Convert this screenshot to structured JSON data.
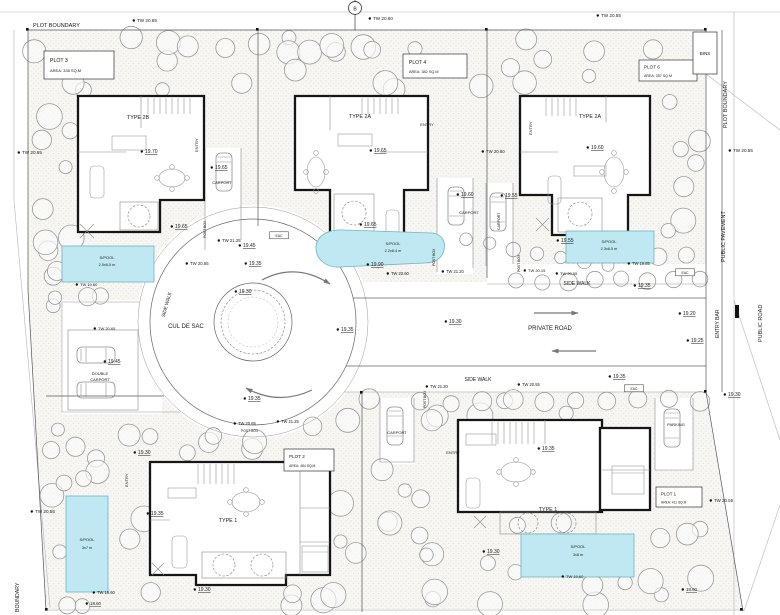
{
  "drawing": {
    "bins_label": "BINS"
  },
  "plots": [
    {
      "name": "PLOT 3",
      "area": "AREA: 338 SQ.M",
      "house_type": "TYPE 2B",
      "pool_label": "S/POOL",
      "pool_size": "2.5x6.5 m"
    },
    {
      "name": "PLOT 4",
      "area": "AREA: 382 SQ.M",
      "house_type": "TYPE 2A",
      "pool_label": "S/POOL",
      "pool_size": "2.2x8.4 m"
    },
    {
      "name": "PLOT 6",
      "area": "AREA: 357 SQ.M",
      "house_type": "TYPE 2A",
      "pool_label": "S/POOL",
      "pool_size": "2.3x6.5 m"
    },
    {
      "name": "PLOT 2",
      "area": "AREA: 484 SQ.M",
      "house_type": "TYPE 1",
      "pool_label": "S/POOL",
      "pool_size": "3x7 m"
    },
    {
      "name": "PLOT 1",
      "area": "AREA: 411 SQ.M",
      "house_type": "TYPE 1",
      "pool_label": "S/POOL",
      "pool_size": "3x8 m"
    }
  ],
  "labels": [
    {
      "t": "PLOT BOUNDARY",
      "x": 33,
      "y": 27,
      "s": 5.5,
      "n": "boundary-label"
    },
    {
      "t": "TW 20.65",
      "x": 137,
      "y": 22,
      "s": 4.6,
      "d": 1
    },
    {
      "t": "TW 20.60",
      "x": 373,
      "y": 20,
      "s": 4.6,
      "d": 1
    },
    {
      "t": "TW 20.55",
      "x": 601,
      "y": 17,
      "s": 4.6,
      "d": 1
    },
    {
      "t": "B",
      "x": 355,
      "y": 10.5,
      "s": 5,
      "a": "m",
      "n": "section-marker-label"
    },
    {
      "t": "PLOT BOUNDARY",
      "x": 727,
      "y": 128,
      "s": 5.5,
      "r": -90,
      "n": "boundary-label"
    },
    {
      "t": "TW 20.55",
      "x": 733,
      "y": 152,
      "s": 4.6,
      "d": 1
    },
    {
      "t": "PUBLIC PAVEMENT",
      "x": 725,
      "y": 262,
      "s": 5.5,
      "r": -90,
      "n": "boundary-label"
    },
    {
      "t": "ENTRY BAR",
      "x": 719,
      "y": 338,
      "s": 5,
      "r": -90,
      "n": "road-label"
    },
    {
      "t": "PUBLIC ROAD",
      "x": 762,
      "y": 342,
      "s": 5.5,
      "r": -90,
      "n": "road-label"
    },
    {
      "t": "TW 20.65",
      "x": 22,
      "y": 154,
      "s": 4.6,
      "d": 1
    },
    {
      "t": "TW 20.55",
      "x": 35,
      "y": 513,
      "s": 4.6,
      "d": 1
    },
    {
      "t": "BOUNDARY",
      "x": 19,
      "y": 612,
      "s": 5.2,
      "r": -90,
      "n": "boundary-label"
    },
    {
      "ref": "plots.0.house_type",
      "x": 138,
      "y": 119,
      "s": 5.4,
      "a": "m",
      "n": "house-type-label"
    },
    {
      "t": "ENTRY",
      "x": 198,
      "y": 152,
      "s": 4,
      "r": -90
    },
    {
      "t": "19.70",
      "x": 145,
      "y": 153,
      "u": 1,
      "d": 1
    },
    {
      "t": "19.65",
      "x": 215,
      "y": 169,
      "u": 1,
      "d": 1
    },
    {
      "t": "CARPORT",
      "x": 222,
      "y": 184,
      "s": 4,
      "a": "m"
    },
    {
      "ref": "plots.0.pool_label",
      "x": 107,
      "y": 259,
      "s": 4,
      "a": "m",
      "n": "pool-label"
    },
    {
      "ref": "plots.0.pool_size",
      "x": 107,
      "y": 266,
      "s": 3.8,
      "a": "m",
      "n": "pool-size-label"
    },
    {
      "t": "TW 19.60",
      "x": 80,
      "y": 286,
      "s": 4,
      "d": 1
    },
    {
      "t": "19.65",
      "x": 175,
      "y": 228,
      "u": 1,
      "d": 1
    },
    {
      "t": "POST BOX",
      "x": 206,
      "y": 238,
      "s": 3.4,
      "r": -90
    },
    {
      "t": "TW 21.25",
      "x": 222,
      "y": 242,
      "s": 4.3,
      "d": 1
    },
    {
      "t": "19.45",
      "x": 243,
      "y": 247,
      "u": 1,
      "d": 1
    },
    {
      "t": "TW 20.65",
      "x": 190,
      "y": 265,
      "s": 4.3,
      "d": 1
    },
    {
      "t": "19.35",
      "x": 249,
      "y": 265,
      "u": 1,
      "d": 1
    },
    {
      "t": "EAC",
      "x": 279,
      "y": 237,
      "s": 3.4,
      "a": "m",
      "box": 1
    },
    {
      "ref": "plots.1.house_type",
      "x": 360,
      "y": 118,
      "s": 5.4,
      "a": "m",
      "n": "house-type-label"
    },
    {
      "t": "ENTRY",
      "x": 427,
      "y": 126,
      "s": 4,
      "a": "m"
    },
    {
      "t": "19.65",
      "x": 374,
      "y": 152,
      "u": 1,
      "d": 1
    },
    {
      "t": "19.65",
      "x": 364,
      "y": 226,
      "u": 1,
      "d": 1
    },
    {
      "ref": "plots.1.pool_label",
      "x": 393,
      "y": 245,
      "s": 4,
      "a": "m",
      "n": "pool-label"
    },
    {
      "ref": "plots.1.pool_size",
      "x": 393,
      "y": 252,
      "s": 3.8,
      "a": "m",
      "n": "pool-size-label"
    },
    {
      "t": "19.90",
      "x": 371,
      "y": 266,
      "u": 1,
      "d": 1
    },
    {
      "t": "TW 20.60",
      "x": 391,
      "y": 275,
      "s": 4.1,
      "d": 1
    },
    {
      "t": "19.60",
      "x": 461,
      "y": 196,
      "u": 1,
      "d": 1
    },
    {
      "t": "CARPORT",
      "x": 469,
      "y": 214,
      "s": 4,
      "a": "m"
    },
    {
      "t": "TW 21.20",
      "x": 446,
      "y": 273,
      "s": 4.1,
      "d": 1
    },
    {
      "t": "POST BOX",
      "x": 435,
      "y": 266,
      "s": 3.4,
      "r": -90
    },
    {
      "t": "TW 20.60",
      "x": 486,
      "y": 153,
      "s": 4.3,
      "d": 1
    },
    {
      "ref": "plots.2.house_type",
      "x": 590,
      "y": 118,
      "s": 5.4,
      "a": "m",
      "n": "house-type-label"
    },
    {
      "t": "ENTRY",
      "x": 532,
      "y": 135,
      "s": 4,
      "r": -90
    },
    {
      "t": "19.60",
      "x": 591,
      "y": 149,
      "u": 1,
      "d": 1
    },
    {
      "t": "19.55",
      "x": 505,
      "y": 197,
      "u": 1,
      "d": 1
    },
    {
      "t": "CARPORT",
      "x": 500,
      "y": 230,
      "s": 3.6,
      "r": -90
    },
    {
      "t": "19.55",
      "x": 561,
      "y": 242,
      "u": 1,
      "d": 1
    },
    {
      "ref": "plots.2.pool_label",
      "x": 609,
      "y": 243,
      "s": 4,
      "a": "m",
      "n": "pool-label"
    },
    {
      "ref": "plots.2.pool_size",
      "x": 609,
      "y": 250,
      "s": 3.8,
      "a": "m",
      "n": "pool-size-label"
    },
    {
      "t": "TW 19.85",
      "x": 632,
      "y": 265,
      "s": 4.1,
      "d": 1
    },
    {
      "t": "TW 20.15",
      "x": 528,
      "y": 272,
      "s": 4,
      "d": 1
    },
    {
      "t": "TW 20.55",
      "x": 560,
      "y": 275,
      "s": 4,
      "d": 1
    },
    {
      "t": "SIDE WALK",
      "x": 577,
      "y": 285,
      "s": 5,
      "a": "m",
      "n": "road-label"
    },
    {
      "t": "19.35",
      "x": 638,
      "y": 287,
      "u": 1,
      "d": 1
    },
    {
      "t": "EAC",
      "x": 685,
      "y": 274,
      "s": 3.4,
      "a": "m",
      "box": 1
    },
    {
      "t": "POST BOX",
      "x": 520,
      "y": 272,
      "s": 3.4,
      "r": -90
    },
    {
      "t": "CUL DE SAC",
      "x": 186,
      "y": 328,
      "s": 6,
      "a": "m",
      "n": "road-label"
    },
    {
      "t": "SIDE WALK",
      "x": 168,
      "y": 305,
      "s": 4.8,
      "r": -75,
      "a": "m",
      "n": "road-label"
    },
    {
      "t": "19.30",
      "x": 239,
      "y": 293,
      "u": 1,
      "d": 1
    },
    {
      "t": "19.35",
      "x": 341,
      "y": 331,
      "u": 1,
      "d": 1
    },
    {
      "t": "19.30",
      "x": 449,
      "y": 323,
      "u": 1,
      "d": 1
    },
    {
      "t": "PRIVATE ROAD",
      "x": 550,
      "y": 330,
      "s": 6,
      "a": "m",
      "n": "road-label"
    },
    {
      "t": "19.20",
      "x": 683,
      "y": 315,
      "u": 1,
      "d": 1
    },
    {
      "t": "19.25",
      "x": 691,
      "y": 342,
      "u": 1,
      "d": 1
    },
    {
      "t": "19.35",
      "x": 248,
      "y": 400,
      "u": 1,
      "d": 1
    },
    {
      "t": "TW 21.20",
      "x": 430,
      "y": 388,
      "s": 4.1,
      "d": 1
    },
    {
      "t": "SIDE WALK",
      "x": 478,
      "y": 381,
      "s": 5,
      "a": "m",
      "n": "road-label"
    },
    {
      "t": "TW 20.55",
      "x": 522,
      "y": 386,
      "s": 4.1,
      "d": 1
    },
    {
      "t": "19.35",
      "x": 613,
      "y": 378,
      "u": 1,
      "d": 1
    },
    {
      "t": "EAC",
      "x": 634,
      "y": 390,
      "s": 3.4,
      "a": "m",
      "box": 1
    },
    {
      "t": "19.30",
      "x": 728,
      "y": 396,
      "u": 1,
      "d": 1
    },
    {
      "t": "TW 20.65",
      "x": 98,
      "y": 330,
      "s": 4,
      "d": 1
    },
    {
      "t": "19.45",
      "x": 108,
      "y": 363,
      "u": 1,
      "d": 1
    },
    {
      "t": "DOUBLE",
      "x": 100,
      "y": 375,
      "s": 4,
      "a": "m"
    },
    {
      "t": "CARPORT",
      "x": 100,
      "y": 381,
      "s": 4,
      "a": "m"
    },
    {
      "t": "TW 20.65",
      "x": 238,
      "y": 425,
      "s": 4.1,
      "d": 1
    },
    {
      "t": "TW 21.25",
      "x": 281,
      "y": 423,
      "s": 4.1,
      "d": 1
    },
    {
      "t": "POST BOX",
      "x": 241,
      "y": 432,
      "s": 3.4
    },
    {
      "t": "19.30",
      "x": 138,
      "y": 454,
      "u": 1,
      "d": 1
    },
    {
      "t": "ENTRY",
      "x": 128,
      "y": 487,
      "s": 4,
      "r": -90
    },
    {
      "t": "19.35",
      "x": 151,
      "y": 515,
      "u": 1,
      "d": 1
    },
    {
      "ref": "plots.3.house_type",
      "x": 228,
      "y": 522,
      "s": 5.4,
      "a": "m",
      "n": "house-type-label"
    },
    {
      "ref": "plots.3.pool_label",
      "x": 87,
      "y": 541,
      "s": 4,
      "a": "m",
      "n": "pool-label"
    },
    {
      "ref": "plots.3.pool_size",
      "x": 87,
      "y": 549,
      "s": 3.8,
      "a": "m",
      "n": "pool-size-label"
    },
    {
      "t": "TW 19.60",
      "x": 97,
      "y": 594,
      "s": 4.1,
      "d": 1
    },
    {
      "t": "18.60",
      "x": 90,
      "y": 605,
      "s": 4.4,
      "u": 1,
      "d": 1
    },
    {
      "t": "19.30",
      "x": 198,
      "y": 591,
      "u": 1,
      "d": 1
    },
    {
      "t": "POST BOX",
      "x": 426,
      "y": 408,
      "s": 3.4,
      "r": -90
    },
    {
      "t": "CARPORT",
      "x": 397,
      "y": 434,
      "s": 4,
      "a": "m"
    },
    {
      "t": "ENTRY",
      "x": 453,
      "y": 454,
      "s": 4,
      "a": "m"
    },
    {
      "t": "19.35",
      "x": 542,
      "y": 450,
      "u": 1,
      "d": 1
    },
    {
      "ref": "plots.4.house_type",
      "x": 548,
      "y": 511,
      "s": 5.4,
      "a": "m",
      "n": "house-type-label"
    },
    {
      "t": "PARKING",
      "x": 676,
      "y": 426,
      "s": 4,
      "a": "m"
    },
    {
      "t": "TW 20.55",
      "x": 714,
      "y": 502,
      "s": 4.4,
      "d": 1
    },
    {
      "t": "19.30",
      "x": 487,
      "y": 553,
      "u": 1,
      "d": 1
    },
    {
      "ref": "plots.4.pool_label",
      "x": 578,
      "y": 548,
      "s": 4,
      "a": "m",
      "n": "pool-label"
    },
    {
      "ref": "plots.4.pool_size",
      "x": 578,
      "y": 556,
      "s": 3.8,
      "a": "m",
      "n": "pool-size-label"
    },
    {
      "t": "TW 19.60",
      "x": 566,
      "y": 578,
      "s": 4,
      "d": 1
    },
    {
      "t": "18.60",
      "x": 686,
      "y": 591,
      "s": 4.4,
      "u": 1,
      "d": 1
    }
  ],
  "vegetation": {
    "regions": [
      [
        34,
        36,
        664,
        54,
        30
      ],
      [
        30,
        95,
        46,
        198,
        10
      ],
      [
        652,
        92,
        52,
        200,
        9
      ],
      [
        48,
        418,
        314,
        190,
        30
      ],
      [
        368,
        392,
        334,
        216,
        30
      ],
      [
        52,
        296,
        118,
        34,
        4
      ]
    ],
    "rows": [
      [
        516,
        281,
        700,
        279,
        8,
        8
      ],
      [
        420,
        402,
        700,
        400,
        10,
        9
      ],
      [
        466,
        240,
        608,
        266,
        7,
        7
      ]
    ]
  }
}
